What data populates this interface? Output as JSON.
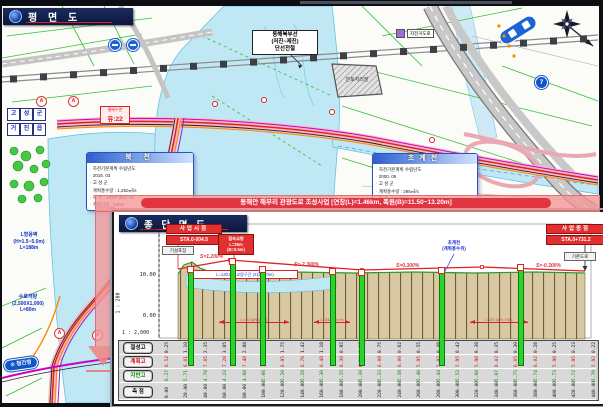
{
  "plan": {
    "title": "평 면 도",
    "banner_text": "동해안 해무리 관광도로 조성사업 [연장(L)=1.46km, 폭원(B)=11.50~13.20m]",
    "railway_label": [
      "동해북부선",
      "(저진~제진)",
      "단선전철"
    ],
    "legend_bukcheon": {
      "title": "북 천",
      "items": [
        "하천기본계획 수립년도",
        "2016. 03",
        "고 성 군",
        "계획홍수량 : 1,250㎥/s",
        "하 폭 : 182m (B/A=0)",
        "계획하폭 : 180m"
      ]
    },
    "legend_chogyecheon": {
      "title": "초계천",
      "items": [
        "하천기본계획 수립년도",
        "2000. 05",
        "고 성 군",
        "계획홍수량 : 295㎥/s",
        "하 폭 : 50~80m",
        "계획하폭 : 50m"
      ]
    },
    "culvert_box": [
      "횡배수관",
      "유:22"
    ],
    "lwall": [
      "L형옹벽",
      "(H=1.5~5.0m)",
      "L=188m"
    ],
    "waterway": [
      "수로개량",
      "(2,500X1,000)",
      "L=80m"
    ],
    "dest_pill": "⊙ 청간정",
    "bike_label": "자전거도로",
    "route_shield": "7",
    "spoil_label": "잔토처리장",
    "marker_a": "A",
    "icon_grid": [
      "고",
      "성",
      "군",
      "거",
      "진",
      "읍"
    ]
  },
  "profile": {
    "title": "종 단 면 도",
    "scale_h": "1 : 2,000",
    "scale_v": "1 : 200",
    "elev": [
      "20.00",
      "10.00",
      "0.00"
    ],
    "start_box": [
      "사업시점",
      "STA.0-004.5"
    ],
    "end_box": [
      "사업종점",
      "STA.0+731.2"
    ],
    "bridge_box": [
      "접속교량",
      "L=35m",
      "(B=9.5m)"
    ],
    "pave_left": "기설포장",
    "pave_right": "기존도로",
    "water_label": [
      "초계천",
      "(계획홍수위)"
    ],
    "bridge_note": "L=120.0m 교량구간 (2@60.0m)",
    "slopes": [
      "S=1.200%",
      "S=-2.300%",
      "S=0.300%",
      "S=-0.300%"
    ],
    "curve_spans": [
      "L=70.0(R=500)",
      "L=34.0(R=∞)",
      "L=57.0(R=700)"
    ],
    "rows": [
      {
        "label": "절성고",
        "color": "#111111",
        "values": [
          "0.25",
          "1.10",
          "2.35",
          "3.05",
          "2.88",
          "2.15",
          "1.75",
          "1.42",
          "1.18",
          "0.95",
          "0.88",
          "0.75",
          "0.62",
          "0.55",
          "0.48",
          "0.42",
          "0.38",
          "0.35",
          "0.30",
          "0.28",
          "0.25",
          "0.23",
          "0.22"
        ]
      },
      {
        "label": "계획고",
        "color": "#cc1111",
        "values": [
          "6.52",
          "6.81",
          "7.05",
          "7.28",
          "7.48",
          "7.21",
          "6.95",
          "6.70",
          "6.48",
          "6.30",
          "6.18",
          "6.08",
          "6.00",
          "5.95",
          "5.92",
          "5.95",
          "5.98",
          "6.02",
          "6.05",
          "6.02",
          "5.98",
          "5.95",
          "5.92"
        ]
      },
      {
        "label": "지반고",
        "color": "#0a8a0a",
        "values": [
          "6.27",
          "5.71",
          "4.70",
          "4.23",
          "4.60",
          "5.06",
          "5.20",
          "5.28",
          "5.30",
          "5.35",
          "5.30",
          "5.33",
          "5.38",
          "5.40",
          "5.44",
          "5.53",
          "5.60",
          "5.67",
          "5.75",
          "5.74",
          "5.73",
          "5.72",
          "5.70"
        ]
      },
      {
        "label": "측 점",
        "color": "#111111",
        "values": [
          "0.00",
          "20.00",
          "40.00",
          "60.00",
          "80.00",
          "100.00",
          "120.00",
          "140.00",
          "160.00",
          "180.00",
          "200.00",
          "220.00",
          "240.00",
          "260.00",
          "280.00",
          "300.00",
          "320.00",
          "340.00",
          "360.00",
          "380.00",
          "400.00",
          "420.00",
          "440.00"
        ]
      }
    ],
    "borings": [
      {
        "x": 74,
        "top": 60
      },
      {
        "x": 116,
        "top": 52
      },
      {
        "x": 146,
        "top": 60
      },
      {
        "x": 216,
        "top": 62
      },
      {
        "x": 245,
        "top": 63
      },
      {
        "x": 325,
        "top": 61
      },
      {
        "x": 404,
        "top": 58
      }
    ]
  }
}
